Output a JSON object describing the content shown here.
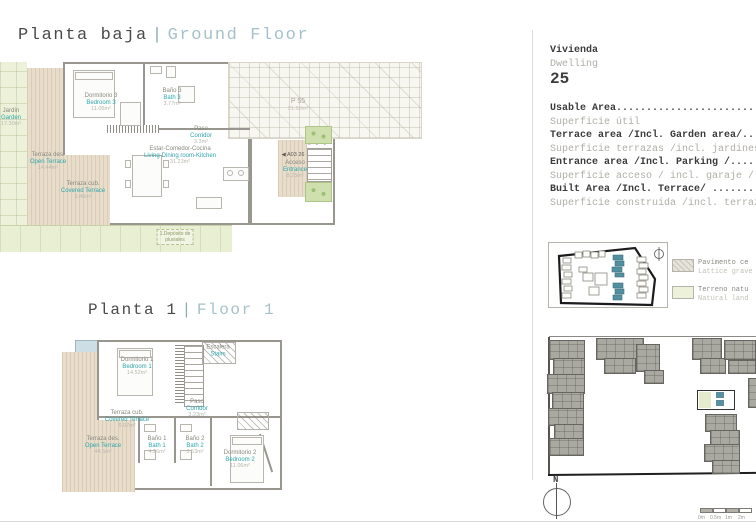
{
  "titles": {
    "ground_es": "Planta baja",
    "ground_sep": "|",
    "ground_en": "Ground Floor",
    "floor1_es": "Planta 1",
    "floor1_sep": "|",
    "floor1_en": "Floor 1"
  },
  "sidebar": {
    "vivienda": "Vivienda",
    "dwelling": "Dwelling",
    "number": "25",
    "areas": [
      {
        "en": "Usable Area...................................",
        "es": "Superficie útil"
      },
      {
        "en": "Terrace area /Incl. Garden area/..............",
        "es": "Superficie terrazas /incl. jardines/"
      },
      {
        "en": "Entrance area /Incl. Parking /................",
        "es": "Superficie acceso / incl. garaje /"
      },
      {
        "en": "Built Area /Incl. Terrace/ ...................",
        "es": "Superficie construida /incl. terraza/"
      }
    ],
    "legend": [
      {
        "es": "Pavimento ce",
        "en": "Lattice grave",
        "color": "#e6e4da"
      },
      {
        "es": "Terreno natu",
        "en": "Natural land",
        "color": "#eef1da"
      }
    ],
    "compass_n": "N",
    "scale_labels": [
      "0m",
      "0.5m",
      "1m",
      "2m"
    ]
  },
  "ground": {
    "rooms": [
      {
        "es": "Jardín",
        "en": "Garden",
        "area": "17.30m²"
      },
      {
        "es": "Terraza des.",
        "en": "Open Terrace",
        "area": "14.44m²"
      },
      {
        "es": "Terraza cub.",
        "en": "Covered Terrace",
        "area": "3.46m²"
      },
      {
        "es": "Dormitorio 3",
        "en": "Bedroom 3",
        "area": "11.05m²"
      },
      {
        "es": "Baño 3",
        "en": "Bath 3",
        "area": "3.77m²"
      },
      {
        "es": "Estar-Comedor-Cocina",
        "en": "Living-Dining room-Kitchen",
        "area": "31.23m²"
      },
      {
        "es": "Paso",
        "en": "Corridor",
        "area": "3.3m²"
      },
      {
        "es": "Acceso",
        "en": "Entrance",
        "area": "8.25m²"
      }
    ],
    "parking_label": "P 55",
    "parking_area": "21.58m²",
    "unit_tag": "◀ A03 26",
    "stair_numbers": "3 2 1",
    "footnote_line1": "1.Depósito de",
    "footnote_line2": "pluviales"
  },
  "floor1": {
    "rooms": [
      {
        "es": "Dormitorio 1",
        "en": "Bedroom 1",
        "area": "14.52m²"
      },
      {
        "es": "Terraza des.",
        "en": "Open Terrace",
        "area": "44.5m²"
      },
      {
        "es": "Terraza cub.",
        "en": "Covered Terrace",
        "area": "6.07m²"
      },
      {
        "es": "Baño 1",
        "en": "Bath 1",
        "area": "4.26m²"
      },
      {
        "es": "Baño 2",
        "en": "Bath 2",
        "area": "3.53m²"
      },
      {
        "es": "Dormitorio 2",
        "en": "Bedroom 2",
        "area": "11.06m²"
      },
      {
        "es": "Paso",
        "en": "Corridor",
        "area": "3.23m²"
      },
      {
        "es": "Escalera",
        "en": "Stairs",
        "area": ""
      }
    ]
  },
  "colors": {
    "accent_teal": "#2fa6ab",
    "title_teal": "#a5c2ca",
    "map_teal": "#53909f",
    "garden_green": "#edf1da",
    "terrace_tan": "#e8ddcb"
  }
}
